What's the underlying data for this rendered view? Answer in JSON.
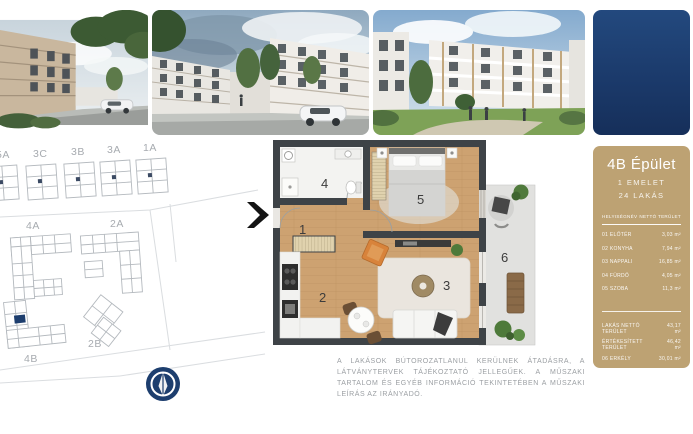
{
  "sidebar": {
    "title": "4B Épület",
    "floor_label": "1 EMELET",
    "apartment_count_label": "24 LAKÁS",
    "table": {
      "header": {
        "name": "HELYISÉGNÉV",
        "area": "NETTÓ TERÜLET"
      },
      "rooms": [
        {
          "name": "01 ELŐTÉR",
          "area": "3,03 m²"
        },
        {
          "name": "02 KONYHA",
          "area": "7,94 m²"
        },
        {
          "name": "03 NAPPALI",
          "area": "16,85 m²"
        },
        {
          "name": "04 FÜRDŐ",
          "area": "4,05 m²"
        },
        {
          "name": "05 SZOBA",
          "area": "11,3 m²"
        }
      ],
      "totals": [
        {
          "name": "LAKÁS NETTÓ TERÜLET",
          "area": "43,17 m²"
        },
        {
          "name": "ÉRTÉKESÍTETT TERÜLET",
          "area": "46,42 m²"
        },
        {
          "name": "06 ERKÉLY",
          "area": "30,01 m²"
        }
      ]
    }
  },
  "siteplan": {
    "building_labels": [
      "5A",
      "3C",
      "3B",
      "3A",
      "1A",
      "4A",
      "2A",
      "2B",
      "4B"
    ],
    "highlight_color": "#1d3e6e"
  },
  "floorplan": {
    "room_numbers": {
      "hall": "1",
      "kitchen": "2",
      "living": "3",
      "bathroom": "4",
      "bedroom": "5",
      "terrace": "6"
    }
  },
  "disclaimer": {
    "text": "A lakások bútorozatlanul kerülnek átadásra, a látványtervek tájékoztató jellegűek. A műszaki tartalom és egyéb információ tekintetében a műszaki leírás az irányadó."
  },
  "colors": {
    "navy": "#1d3e6e",
    "tan": "#bda273",
    "wall": "#3e4347",
    "wood": "#cda271",
    "terrace": "#e1e1df"
  }
}
